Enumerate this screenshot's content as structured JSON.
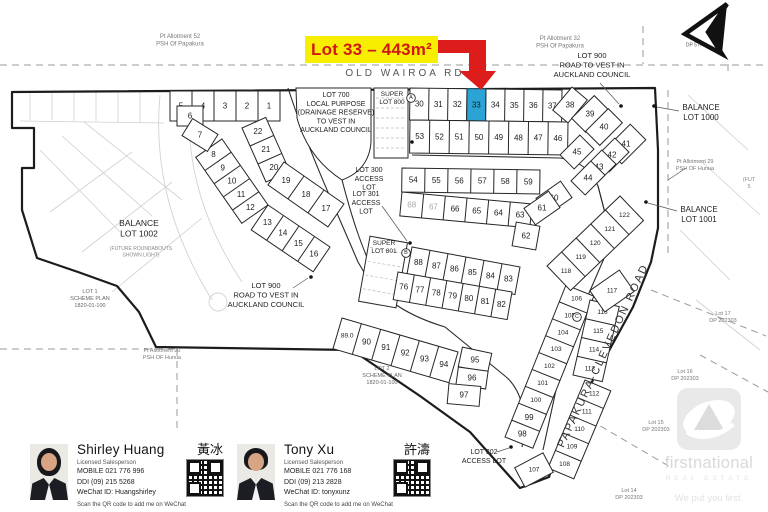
{
  "banner": {
    "text": "Lot 33 – 443m²",
    "bg": "#f7ee00",
    "fg": "#d01818",
    "arrow_color": "#dd1c1c"
  },
  "map": {
    "highlight_color": "#2ba3d4",
    "road_top": "OLD WAIROA RD",
    "road_right": "PAPAKURA-CLEVEDON ROAD",
    "labels": [
      {
        "t": [
          "Pt Allotment 52",
          "PSH Of Papakura"
        ],
        "x": 180,
        "y": 38,
        "s": 6,
        "c": "#777"
      },
      {
        "t": [
          "Pt Allotment 32",
          "PSH Of Papakura"
        ],
        "x": 560,
        "y": 40,
        "s": 6,
        "c": "#777"
      },
      {
        "t": [
          "LOT 900",
          "ROAD TO VEST IN",
          "AUCKLAND COUNCIL"
        ],
        "x": 592,
        "y": 58,
        "s": 7.5,
        "c": "#222"
      },
      {
        "t": [
          "Lot 1",
          "DP 57700"
        ],
        "x": 697,
        "y": 40,
        "s": 5,
        "c": "#555"
      },
      {
        "t": [
          "OLD WAIROA RD"
        ],
        "x": 405,
        "y": 76,
        "s": 10,
        "c": "#555",
        "ls": 3
      },
      {
        "t": [
          "LOT 700",
          "LOCAL PURPOSE",
          "(DRAINAGE RESERVE)",
          "TO VEST IN",
          "AUCKLAND COUNCIL"
        ],
        "x": 336,
        "y": 97,
        "s": 7,
        "c": "#222"
      },
      {
        "t": [
          "SUPER",
          "LOT 800"
        ],
        "x": 392,
        "y": 96,
        "s": 6.5,
        "c": "#222"
      },
      {
        "t": [
          "BALANCE",
          "LOT 1000"
        ],
        "x": 701,
        "y": 110,
        "s": 8,
        "c": "#222"
      },
      {
        "t": [
          "Pt Allotment 29",
          "PSH OF Hunua"
        ],
        "x": 695,
        "y": 163,
        "s": 5.5,
        "c": "#777"
      },
      {
        "t": [
          "(FUT",
          "5"
        ],
        "x": 749,
        "y": 181,
        "s": 5.5,
        "c": "#888"
      },
      {
        "t": [
          "LOT 300",
          "ACCESS",
          "LOT"
        ],
        "x": 369,
        "y": 172,
        "s": 7,
        "c": "#222"
      },
      {
        "t": [
          "LOT 301",
          "ACCESS",
          "LOT"
        ],
        "x": 366,
        "y": 196,
        "s": 7,
        "c": "#222"
      },
      {
        "t": [
          "BALANCE",
          "LOT 1002"
        ],
        "x": 139,
        "y": 226,
        "s": 8.5,
        "c": "#222"
      },
      {
        "t": [
          "(FUTURE ROUNDABOUTS",
          "SHOWN LIGHT)"
        ],
        "x": 141,
        "y": 250,
        "s": 5,
        "c": "#888"
      },
      {
        "t": [
          "SUPER",
          "LOT 801"
        ],
        "x": 384,
        "y": 245,
        "s": 6.5,
        "c": "#222"
      },
      {
        "t": [
          "BALANCE",
          "LOT 1001"
        ],
        "x": 699,
        "y": 212,
        "s": 8,
        "c": "#222"
      },
      {
        "t": [
          "LOT 900",
          "ROAD TO VEST IN",
          "AUCKLAND COUNCIL"
        ],
        "x": 266,
        "y": 288,
        "s": 7.5,
        "c": "#222"
      },
      {
        "t": [
          "LOT 1",
          "SCHEME PLAN",
          "1820-01-100"
        ],
        "x": 90,
        "y": 293,
        "s": 5.5,
        "c": "#666"
      },
      {
        "t": [
          "Lot 17",
          "DP 202303"
        ],
        "x": 723,
        "y": 315,
        "s": 5.5,
        "c": "#777"
      },
      {
        "t": [
          "Pt Allotment 20",
          "PSH OF Hunua"
        ],
        "x": 162,
        "y": 352,
        "s": 5.5,
        "c": "#777"
      },
      {
        "t": [
          "LOT 2",
          "SCHEME PLAN",
          "1820-01-100"
        ],
        "x": 382,
        "y": 370,
        "s": 5.5,
        "c": "#666"
      },
      {
        "t": [
          "Lot 16",
          "DP 202303"
        ],
        "x": 685,
        "y": 373,
        "s": 5.5,
        "c": "#777"
      },
      {
        "t": [
          "Lot 15",
          "DP 202303"
        ],
        "x": 656,
        "y": 424,
        "s": 5.5,
        "c": "#777"
      },
      {
        "t": [
          "LOT 302",
          "ACCESS LOT"
        ],
        "x": 484,
        "y": 454,
        "s": 7,
        "c": "#222"
      },
      {
        "t": [
          "Lot 14",
          "DP 202303"
        ],
        "x": 629,
        "y": 492,
        "s": 5.5,
        "c": "#777"
      },
      {
        "t": [
          "PAPAKURA-CLEVEDON ROAD"
        ],
        "x": 606,
        "y": 357,
        "s": 11,
        "c": "#333",
        "ls": 2,
        "rot": -65
      }
    ],
    "strips": [
      {
        "x1": 410,
        "y1": 88,
        "x2": 562,
        "y2": 90,
        "w": 32,
        "cells": [
          "30",
          "31",
          "32",
          {
            "n": "33",
            "hl": 1
          },
          "34",
          "35",
          "36",
          "37"
        ]
      },
      {
        "x1": 410,
        "y1": 120,
        "x2": 568,
        "y2": 122,
        "w": 33,
        "cells": [
          "53",
          "52",
          "51",
          "50",
          "49",
          "48",
          "47",
          "46"
        ]
      },
      {
        "x1": 402,
        "y1": 168,
        "x2": 540,
        "y2": 170,
        "w": 24,
        "cells": [
          "54",
          "55",
          "56",
          "57",
          "58",
          "59"
        ]
      },
      {
        "x1": 402,
        "y1": 192,
        "x2": 532,
        "y2": 204,
        "w": 24,
        "cells": [
          {
            "n": "68",
            "lt": 1
          },
          {
            "n": "67",
            "lt": 1
          },
          "66",
          "65",
          "64",
          "63"
        ]
      },
      {
        "x1": 170,
        "y1": 91,
        "x2": 280,
        "y2": 91,
        "w": 30,
        "cells": [
          "5",
          "4",
          "3",
          "2",
          "1"
        ]
      },
      {
        "x1": 222,
        "y1": 139,
        "x2": 268,
        "y2": 205,
        "w": 32,
        "cells": [
          "8",
          "9",
          "10",
          "11",
          "12"
        ]
      },
      {
        "x1": 268,
        "y1": 205,
        "x2": 330,
        "y2": 247,
        "w": 30,
        "cells": [
          "13",
          "14",
          "15",
          "16"
        ]
      },
      {
        "x1": 266,
        "y1": 182,
        "x2": 242,
        "y2": 128,
        "w": 26,
        "cells": [
          "20",
          "21",
          "22"
        ]
      },
      {
        "x1": 284,
        "y1": 162,
        "x2": 344,
        "y2": 204,
        "w": 28,
        "cells": [
          "19",
          "18",
          "17"
        ]
      },
      {
        "x1": 342,
        "y1": 318,
        "x2": 458,
        "y2": 352,
        "w": 32,
        "cells": [
          "89.0",
          "90",
          "91",
          "92",
          "93",
          "94"
        ]
      },
      {
        "x1": 505,
        "y1": 437,
        "x2": 566,
        "y2": 285,
        "w": 30,
        "cells": [
          "98",
          "99",
          "100",
          "101",
          "102",
          "103",
          "104",
          "105",
          "106"
        ]
      },
      {
        "x1": 548,
        "y1": 468,
        "x2": 585,
        "y2": 380,
        "w": 28,
        "cells": [
          "108",
          "109",
          "110",
          "111",
          "112"
        ]
      },
      {
        "x1": 573,
        "y1": 375,
        "x2": 590,
        "y2": 300,
        "w": 30,
        "cells": [
          "113",
          "114",
          "115",
          "116"
        ]
      },
      {
        "x1": 547,
        "y1": 266,
        "x2": 620,
        "y2": 196,
        "w": 34,
        "cells": [
          "118",
          "119",
          "120",
          "121",
          "122"
        ]
      },
      {
        "x1": 412,
        "y1": 247,
        "x2": 520,
        "y2": 267,
        "w": 28,
        "cells": [
          "88",
          "87",
          "86",
          "85",
          "84",
          "83"
        ]
      },
      {
        "x1": 398,
        "y1": 272,
        "x2": 512,
        "y2": 292,
        "w": 28,
        "cells": [
          "76",
          "77",
          "78",
          "79",
          "80",
          "81",
          "82"
        ]
      }
    ],
    "rects": [
      {
        "n": "6",
        "x": 190,
        "y": 116,
        "w": 26,
        "h": 20,
        "r": 0
      },
      {
        "n": "7",
        "x": 200,
        "y": 135,
        "w": 30,
        "h": 20,
        "r": 32
      },
      {
        "n": "38",
        "x": 570,
        "y": 105,
        "w": 20,
        "h": 30,
        "r": 40
      },
      {
        "n": "39",
        "x": 590,
        "y": 114,
        "w": 20,
        "h": 32,
        "r": 45
      },
      {
        "n": "40",
        "x": 604,
        "y": 127,
        "w": 20,
        "h": 32,
        "r": 45
      },
      {
        "n": "41",
        "x": 626,
        "y": 144,
        "w": 22,
        "h": 34,
        "r": 45
      },
      {
        "n": "45",
        "x": 577,
        "y": 152,
        "w": 20,
        "h": 28,
        "r": 45
      },
      {
        "n": "42",
        "x": 612,
        "y": 155,
        "w": 20,
        "h": 28,
        "r": 45
      },
      {
        "n": "43",
        "x": 599,
        "y": 167,
        "w": 20,
        "h": 28,
        "r": 45
      },
      {
        "n": "44",
        "x": 588,
        "y": 178,
        "w": 20,
        "h": 28,
        "r": 45
      },
      {
        "n": "60",
        "x": 554,
        "y": 198,
        "w": 20,
        "h": 30,
        "r": 55
      },
      {
        "n": "61",
        "x": 542,
        "y": 208,
        "w": 20,
        "h": 30,
        "r": 55
      },
      {
        "n": "62",
        "x": 526,
        "y": 236,
        "w": 24,
        "h": 24,
        "r": 10
      },
      {
        "n": "95",
        "x": 475,
        "y": 360,
        "w": 30,
        "h": 20,
        "r": 12
      },
      {
        "n": "96",
        "x": 472,
        "y": 378,
        "w": 30,
        "h": 18,
        "r": 8
      },
      {
        "n": "97",
        "x": 464,
        "y": 395,
        "w": 32,
        "h": 20,
        "r": 5
      },
      {
        "n": "107",
        "x": 534,
        "y": 470,
        "w": 32,
        "h": 22,
        "r": -28
      },
      {
        "n": "117",
        "x": 612,
        "y": 291,
        "w": 36,
        "h": 26,
        "r": -35
      }
    ],
    "circled_letters": [
      {
        "ch": "A",
        "x": 411,
        "y": 98
      },
      {
        "ch": "B",
        "x": 406,
        "y": 253
      },
      {
        "ch": "C",
        "x": 577,
        "y": 317
      }
    ],
    "dots": [
      [
        311,
        277
      ],
      [
        621,
        106
      ],
      [
        654,
        106
      ],
      [
        646,
        202
      ],
      [
        410,
        243
      ],
      [
        412,
        142
      ],
      [
        511,
        447
      ]
    ],
    "leaders": [
      [
        293,
        288,
        308,
        278
      ],
      [
        600,
        83,
        619,
        104
      ],
      [
        679,
        111,
        657,
        107
      ],
      [
        677,
        211,
        648,
        203
      ],
      [
        497,
        452,
        509,
        448
      ],
      [
        686,
        168,
        668,
        180
      ],
      [
        382,
        206,
        407,
        241
      ]
    ],
    "dashed_segments": [
      [
        0,
        65,
        768,
        65
      ],
      [
        643,
        26,
        643,
        64
      ],
      [
        728,
        64,
        728,
        75
      ],
      [
        668,
        90,
        668,
        258
      ],
      [
        651,
        290,
        766,
        336
      ],
      [
        590,
        420,
        672,
        468
      ],
      [
        0,
        349,
        175,
        349
      ],
      [
        177,
        349,
        177,
        428
      ],
      [
        700,
        355,
        768,
        392
      ]
    ],
    "light_segments": [
      [
        30,
        92,
        30,
        120
      ],
      [
        52,
        92,
        52,
        120
      ],
      [
        74,
        92,
        74,
        121
      ],
      [
        96,
        92,
        96,
        121
      ],
      [
        118,
        92,
        118,
        122
      ],
      [
        140,
        92,
        140,
        122
      ],
      [
        20,
        121,
        164,
        123
      ],
      [
        40,
        150,
        120,
        232
      ],
      [
        62,
        136,
        152,
        216
      ],
      [
        84,
        122,
        182,
        200
      ],
      [
        50,
        212,
        132,
        152
      ],
      [
        82,
        252,
        172,
        182
      ],
      [
        112,
        292,
        202,
        218
      ],
      [
        688,
        95,
        748,
        150
      ],
      [
        700,
        160,
        760,
        215
      ],
      [
        680,
        230,
        730,
        280
      ],
      [
        696,
        300,
        760,
        350
      ]
    ]
  },
  "agents": [
    {
      "name": "Shirley Huang",
      "cjk": "黃冰",
      "title": "Licensed Salesperson",
      "mobile": "MOBILE 021 776 996",
      "ddi": "DDI (09) 215 5268",
      "wechat": "WeChat ID: Huangshirley",
      "scan": "Scan the QR code to add me on WeChat"
    },
    {
      "name": "Tony Xu",
      "cjk": "許濤",
      "title": "Licensed Salesperson",
      "mobile": "MOBILE 021 776 168",
      "ddi": "DDI (09) 213 2828",
      "wechat": "WeChat ID: tonyxunz",
      "scan": "Scan the QR code to add me on WeChat"
    }
  ],
  "logo": {
    "brand": "firstnational",
    "sub": "REAL ESTATE",
    "tagline": "We put you first."
  }
}
